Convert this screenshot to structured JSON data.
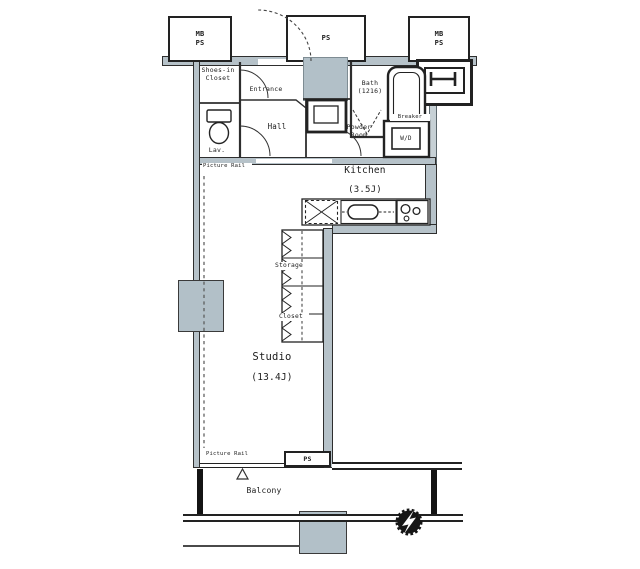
{
  "plan": {
    "type": "apartment-floor-plan",
    "colors": {
      "wall_fill": "#b6c2c9",
      "shaft_fill": "#b2c0c8",
      "line": "#2e2e2e",
      "background": "#ffffff"
    },
    "shafts": {
      "top_left": "MB\nPS",
      "top_mid": "PS",
      "top_right": "MB\nPS",
      "bottom": "PS"
    },
    "rooms": {
      "shoes_closet": "Shoes-in\nCloset",
      "entrance": "Entrance",
      "bath": "Bath\n(1216)",
      "lav": "Lav.",
      "hall": "Hall",
      "powder": "Powder\nRoom",
      "kitchen": "Kitchen",
      "kitchen_size": "(3.5J)",
      "storage": "Storage",
      "closet": "Closet",
      "studio": "Studio",
      "studio_size": "(13.4J)",
      "balcony": "Balcony"
    },
    "fixtures": {
      "washer_dryer": "W/D",
      "breaker": "Breaker"
    },
    "notes": {
      "picture_rail_top": "Picture Rail",
      "picture_rail_bottom": "Picture Rail"
    }
  }
}
